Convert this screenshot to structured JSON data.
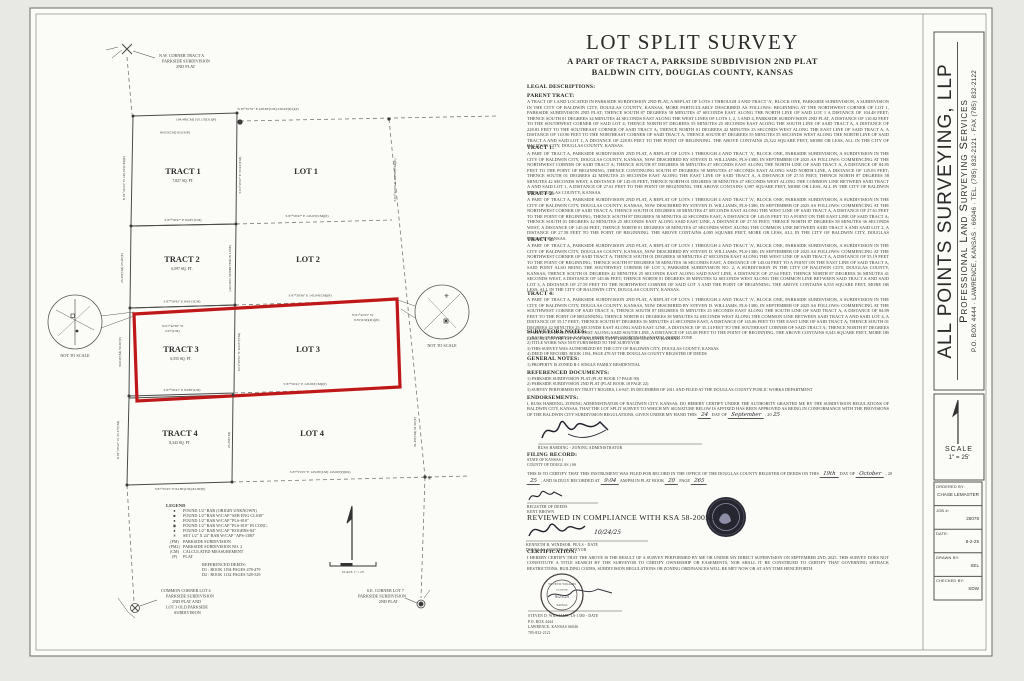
{
  "colors": {
    "paper": "#fbfbf7",
    "background": "#e8e8e4",
    "ink": "#3c3c3c",
    "line": "#4a4a4a",
    "highlight_red": "#c01818",
    "seal_dark": "#262630"
  },
  "header": {
    "title": "LOT SPLIT SURVEY",
    "subtitle1": "A PART OF TRACT A, PARKSIDE SUBDIVISION 2ND PLAT",
    "subtitle2": "BALDWIN CITY, DOUGLAS COUNTY, KANSAS"
  },
  "firm": {
    "name": "ALL POINTS SURVEYING, LLP",
    "tagline": "Professional Land Surveying Services",
    "address": "P.O. BOX 4444 · LAWRENCE, KANSAS · 66046 · TEL. (785) 832-2121 · FAX (785) 832-2122"
  },
  "titleblock": {
    "scale_label": "SCALE",
    "scale_value": "1\" = 25'",
    "fields": [
      {
        "label": "ORDERED BY:",
        "value": "CHASE LEMASTER"
      },
      {
        "label": "JOB #:",
        "value": "25078"
      },
      {
        "label": "DATE:",
        "value": "8-2-25"
      },
      {
        "label": "DRAWN BY:",
        "value": "SEL"
      },
      {
        "label": "CHECKED BY:",
        "value": "SDW"
      }
    ]
  },
  "legal": {
    "title": "LEGAL DESCRIPTIONS:",
    "sections": [
      {
        "heading": "PARENT TRACT:",
        "body": "A TRACT OF LAND LOCATED IN PARKSIDE SUBDIVISION 2ND PLAT, A REPLAT OF LOTS 1 THROUGH 4 AND TRACT 'A', BLOCK ONE, PARKSIDE SUBDIVISION, A SUBDIVISION IN THE CITY OF BALDWIN CITY, DOUGLAS COUNTY, KANSAS, MORE PARTICULARLY DESCRIBED AS FOLLOWS: BEGINNING AT THE NORTHWEST CORNER OF LOT 1, PARKSIDE SUBDIVISION 2ND PLAT; THENCE SOUTH 87 DEGREES 58 MINUTES 47 SECONDS EAST ALONG THE NORTH LINE OF SAID LOT 1 A DISTANCE OF 104.48 FEET; THENCE SOUTH 01 DEGREES 34 MINUTES 44 SECONDS EAST ALONG THE WEST LINES OF LOTS 1, 2, 3 AND 4, PARKSIDE SUBDIVISION 2ND PLAT, A DISTANCE OF 110.82 FEET TO THE SOUTHWEST CORNER OF SAID LOT 4; THENCE NORTH 87 DEGREES 55 MINUTES 25 SECONDS EAST ALONG THE SOUTH LINE OF SAID TRACT A, A DISTANCE OF 228.83 FEET TO THE SOUTHEAST CORNER OF SAID TRACT A; THENCE NORTH 01 DEGREES 42 MINUTES 25 SECONDS WEST ALONG THE EAST LINE OF SAID TRACT A, A DISTANCE OF 110.90 FEET TO THE NORTHEAST CORNER OF SAID TRACT A; THENCE SOUTH 87 DEGREES 55 MINUTES 55 SECONDS WEST ALONG THE NORTH LINE OF SAID TRACT A AND SAID LOT 1, A DISTANCE OF 228.83 FEET TO THE POINT OF BEGINNING. THE ABOVE CONTAINS 25,322 SQUARE FEET, MORE OR LESS, ALL IN THE CITY OF BALDWIN CITY, DOUGLAS COUNTY, KANSAS."
      },
      {
        "heading": "TRACT 1:",
        "body": "A PART OF TRACT A, PARKSIDE SUBDIVISION 2ND PLAT, A REPLAT OF LOTS 1 THROUGH 4 AND TRACT 'A', BLOCK ONE, PARKSIDE SUBDIVISION, A SUBDIVISION IN THE CITY OF BALDWIN CITY, DOUGLAS COUNTY, KANSAS, NOW DESCRIBED BY STEVEN D. WILLIAMS, PLS-1380, IN SEPTEMBER OF 2025 AS FOLLOWS: COMMENCING AT THE NORTHWEST CORNER OF SAID TRACT A; THENCE SOUTH 87 DEGREES 58 MINUTES 47 SECONDS EAST ALONG THE NORTH LINE OF SAID TRACT A, A DISTANCE OF 84.85 FEET TO THE POINT OF BEGINNING; THENCE CONTINUING SOUTH 87 DEGREES 58 MINUTES 47 SECONDS EAST ALONG SAID NORTH LINE, A DISTANCE OF 145.03 FEET; THENCE SOUTH 01 DEGREES 42 MINUTES 25 SECONDS EAST ALONG THE EAST LINE OF SAID TRACT A, A DISTANCE OF 27.55 FEET; THENCE NORTH 87 DEGREES 58 MINUTES 42 SECONDS WEST, A DISTANCE OF 145.05 FEET; THENCE NORTH 01 DEGREES 38 MINUTES 47 SECONDS WEST ALONG THE COMMON LINE BETWEEN SAID TRACT A AND SAID LOT 1, A DISTANCE OF 27.61 FEET TO THE POINT OF BEGINNING. THE ABOVE CONTAINS 3,997 SQUARE FEET, MORE OR LESS, ALL IN THE CITY OF BALDWIN CITY, DOUGLAS COUNTY, KANSAS."
      },
      {
        "heading": "TRACT 2:",
        "body": "A PART OF TRACT A, PARKSIDE SUBDIVISION 2ND PLAT, A REPLAT OF LOTS 1 THROUGH 4 AND TRACT 'A', BLOCK ONE, PARKSIDE SUBDIVISION, A SUBDIVISION IN THE CITY OF BALDWIN CITY, DOUGLAS COUNTY, KANSAS, NOW DESCRIBED BY STEVEN D. WILLIAMS, PLS-1380, IN SEPTEMBER OF 2025 AS FOLLOWS: COMMENCING AT THE NORTHWEST CORNER OF SAID TRACT A; THENCE SOUTH 01 DEGREES 38 MINUTES 47 SECONDS EAST ALONG THE WEST LINE OF SAID TRACT A, A DISTANCE OF 27.61 FEET TO THE POINT OF BEGINNING; THENCE SOUTH 87 DEGREES 58 MINUTES 42 SECONDS EAST, A DISTANCE OF 145.05 FEET TO A POINT ON THE EAST LINE OF SAID TRACT A; THENCE SOUTH 01 DEGREES 42 MINUTES 25 SECONDS EAST ALONG SAID EAST LINE, A DISTANCE OF 27.55 FEET; THENCE NORTH 87 DEGREES 58 MINUTES 36 SECONDS WEST, A DISTANCE OF 145.04 FEET; THENCE NORTH 01 DEGREES 38 MINUTES 47 SECONDS WEST ALONG THE COMMON LINE BETWEEN SAID TRACT A AND SAID LOT 2, A DISTANCE OF 27.58 FEET TO THE POINT OF BEGINNING. THE ABOVE CONTAINS 4,005 SQUARE FEET, MORE OR LESS, ALL IN THE CITY OF BALDWIN CITY, DOUGLAS COUNTY, KANSAS."
      },
      {
        "heading": "TRACT 3:",
        "body": "A PART OF TRACT A, PARKSIDE SUBDIVISION 2ND PLAT, A REPLAT OF LOTS 1 THROUGH 4 AND TRACT 'A', BLOCK ONE, PARKSIDE SUBDIVISION, A SUBDIVISION IN THE CITY OF BALDWIN CITY, DOUGLAS COUNTY, KANSAS, NOW DESCRIBED BY STEVEN D. WILLIAMS, PLS-1380, IN SEPTEMBER OF 2025 AS FOLLOWS: COMMENCING AT THE NORTHWEST CORNER OF SAID TRACT A; THENCE SOUTH 01 DEGREES 38 MINUTES 47 SECONDS EAST ALONG THE WEST LINE OF SAID TRACT A, A DISTANCE OF 55.19 FEET TO THE POINT OF BEGINNING; THENCE SOUTH 87 DEGREES 58 MINUTES 36 SECONDS EAST, A DISTANCE OF 145.04 FEET TO A POINT ON THE EAST LINE OF SAID TRACT A, SAID POINT ALSO BEING THE SOUTHWEST CORNER OF LOT 3, PARKSIDE SUBDIVISION NO. 2, A SUBDIVISION IN THE CITY OF BALDWIN CITY, DOUGLAS COUNTY, KANSAS; THENCE SOUTH 01 DEGREES 42 MINUTES 25 SECONDS EAST ALONG SAID EAST LINE, A DISTANCE OF 27.64 FEET; THENCE NORTH 87 DEGREES 56 MINUTES 41 SECONDS WEST, A DISTANCE OF 145.06 FEET; THENCE NORTH 01 DEGREES 38 MINUTES 52 SECONDS WEST ALONG THE COMMON LINE BETWEEN SAID TRACT A AND SAID LOT 3, A DISTANCE OF 27.59 FEET TO THE NORTHWEST CORNER OF SAID LOT 3 AND THE POINT OF BEGINNING. THE ABOVE CONTAINS 6,555 SQUARE FEET, MORE OR LESS, ALL IN THE CITY OF BALDWIN CITY, DOUGLAS COUNTY, KANSAS."
      },
      {
        "heading": "TRACT 4:",
        "body": "A PART OF TRACT A, PARKSIDE SUBDIVISION 2ND PLAT, A REPLAT OF LOTS 1 THROUGH 4 AND TRACT 'A', BLOCK ONE, PARKSIDE SUBDIVISION, A SUBDIVISION IN THE CITY OF BALDWIN CITY, DOUGLAS COUNTY, KANSAS, NOW DESCRIBED BY STEVEN D. WILLIAMS, PLS-1380, IN SEPTEMBER OF 2025 AS FOLLOWS: COMMENCING AT THE SOUTHWEST CORNER OF SAID TRACT A; THENCE SOUTH 87 DEGREES 55 MINUTES 25 SECONDS EAST ALONG THE SOUTH LINE OF SAID TRACT A, A DISTANCE OF 84.89 FEET TO THE POINT OF BEGINNING; THENCE NORTH 01 DEGREES 38 MINUTES 52 SECONDS WEST ALONG THE COMMON LINE BETWEEN SAID TRACT A AND SAID LOT 4, A DISTANCE OF 35.17 FEET; THENCE SOUTH 87 DEGREES 56 MINUTES 41 SECONDS EAST, A DISTANCE OF 145.06 FEET TO THE EAST LINE OF SAID TRACT A; THENCE SOUTH 01 DEGREES 42 MINUTES 25 SECONDS EAST ALONG SAID EAST LINE, A DISTANCE OF 35.14 FEET TO THE SOUTHEAST CORNER OF SAID TRACT A; THENCE NORTH 87 DEGREES 55 MINUTES 25 SECONDS WEST ALONG SAID SOUTH LINE, A DISTANCE OF 145.08 FEET TO THE POINT OF BEGINNING. THE ABOVE CONTAINS 8,343 SQUARE FEET, MORE OR LESS, ALL IN THE CITY OF BALDWIN CITY, DOUGLAS COUNTY, KANSAS."
      }
    ]
  },
  "notes": {
    "surveyors": {
      "heading": "SURVEYORS NOTES:",
      "lines": [
        "1) BASIS OF BEARINGS: KANSAS STATE PLANE COORDINATE SYSTEM, NORTH ZONE",
        "2) TITLE WORK WAS NOT FURNISHED TO THE SURVEYOR",
        "3) THIS SURVEY WAS AUTHORIZED BY THE CITY OF BALDWIN CITY, DOUGLAS COUNTY, KANSAS",
        "4) DEED OF RECORD: BOOK 1194, PAGE 478 AT THE DOUGLAS COUNTY REGISTER OF DEEDS"
      ]
    },
    "general": {
      "heading": "GENERAL NOTES:",
      "lines": [
        "1) PROPERTY IS ZONED R-1 SINGLE FAMILY RESIDENTIAL"
      ]
    },
    "refdocs": {
      "heading": "REFERENCED DOCUMENTS:",
      "lines": [
        "1) PARKSIDE SUBDIVISION PLAT (PLAT BOOK 17 PAGE 90)",
        "2) PARKSIDE SUBDIVISION 2ND PLAT (PLAT BOOK 18 PAGE 22)",
        "3) SURVEY PERFORMED BY TRUITT ROGERS, LS-847, IN DECEMBER OF 2011 AND FILED AT THE DOUGLAS COUNTY PUBLIC WORKS DEPARTMENT"
      ]
    }
  },
  "endorsements": {
    "heading": "ENDORSEMENTS:",
    "body": "I, RUSS HARDING, ZONING ADMINISTRATOR OF BALDWIN CITY, KANSAS, DO HEREBY CERTIFY UNDER THE AUTHORITY GRANTED ME BY THE SUBDIVISION REGULATIONS OF BALDWIN CITY, KANSAS, THAT THE LOT SPLIT SURVEY TO WHICH MY SIGNATURE BELOW IS AFFIXED HAS BEEN APPROVED AS BEING IN CONFORMANCE WITH THE PROVISIONS OF THE BALDWIN CITY SUBDIVISION REGULATIONS, GIVEN UNDER MY HAND THIS",
    "hand_day": "24",
    "mid1": "DAY OF",
    "hand_month": "September",
    "mid2": ", 20",
    "hand_year": "25",
    "tail": ".",
    "sig_caption": "RUSS HARDING  -  ZONING ADMINISTRATOR"
  },
  "filing": {
    "heading": "FILING RECORD:",
    "state": "STATE OF KANSAS )",
    "county": "COUNTY OF DOUGLAS ) SS",
    "l1": "THIS IS TO CERTIFY THAT THIS INSTRUMENT WAS FILED FOR RECORD IN THE OFFICE OF THE DOUGLAS COUNTY REGISTER OF DEEDS ON THIS",
    "h1": "19th",
    "l2": "DAY OF",
    "h2": "October",
    "l3": ", 20",
    "h3": "25",
    "l4": ", AND IS DULY RECORDED AT",
    "h4": "9:04",
    "l5": "AM/PM IN",
    "l6": "PLAT BOOK",
    "h5": "20",
    "l7": "PAGE",
    "h6": "265",
    "l8": ".",
    "cap1": "REGISTER OF DEEDS",
    "cap2": "KENT BROWN"
  },
  "reviewed": {
    "heading": "REVIEWED IN COMPLIANCE WITH KSA 58-2005 :",
    "hand_date": "10/24/25",
    "cap1": "KENNETH B. WINDSOR, PE/LS  -  DATE",
    "cap2": "DOUGLAS COUNTY SURVEYOR"
  },
  "certification": {
    "heading": "CERTIFICATION:",
    "body": "I HEREBY CERTIFY THAT THE ABOVE IS THE RESULT OF A SURVEY PERFORMED BY ME OR UNDER MY DIRECT SUPERVISION ON SEPTEMBER 2ND, 2025. THIS SURVEY DOES NOT CONSTITUTE A TITLE SEARCH BY THE SURVEYOR TO CERTIFY OWNERSHIP OR EASEMENTS, NOR SHALL IT BE CONSTRUED TO CERTIFY THAT GOVERNING SETBACK RESTRICTIONS, BUILDING CODES, SUBDIVISION REGULATIONS OR ZONING ORDINANCES WILL BE MET NOW OR AT ANY TIME HENCEFORTH."
  },
  "stamp": {
    "arc_top": "STEVEN D. WILLIAMS",
    "mid": "LICENSED",
    "hand_date": "9/23/25",
    "arc_bottom": "KANSAS",
    "cap1": "STEVEN D. WILLIAMS, LS-1380  -  DATE",
    "cap2": "P.O. BOX 4444",
    "cap3": "LAWRENCE, KANSAS 66046",
    "cap4": "785-832-2121"
  },
  "drawing": {
    "corner_nw": [
      "N.W. CORNER TRACT A",
      "PARKSIDE SUBDIVISION",
      "2ND PLAT"
    ],
    "corner_sw": [
      "COMMON CORNER LOT 4",
      "PARKSIDE SUBDIVISION",
      "2ND PLAT AND",
      "LOT 3 OLD PARKSIDE",
      "SUBDIVISION"
    ],
    "corner_se": [
      "S.E. CORNER LOT 7",
      "PARKSIDE SUBDIVISION",
      "2ND PLAT"
    ],
    "tracts": [
      {
        "name": "TRACT 1",
        "area": "7,827 SQ. FT."
      },
      {
        "name": "TRACT 2",
        "area": "6,597 SQ. FT."
      },
      {
        "name": "TRACT 3",
        "area": "6,555 SQ. FT."
      },
      {
        "name": "TRACT 4",
        "area": "8,343 SQ. FT."
      }
    ],
    "lots": [
      "LOT 1",
      "LOT 2",
      "LOT 3",
      "LOT 4"
    ],
    "not_to_scale": "NOT TO SCALE",
    "north_caption": "SCALE 1\" = 25'",
    "bearings": {
      "top_left": "104.48'(CM) 105.13'(D1)(P)",
      "top_inner": "84.05'(CM) 85.03'(P)",
      "top": "N 87°55'55\" E  228.83'(CM) 230.03'(D1)(P)",
      "t12_left": "S 87°58'47\" E  84.85'(CM)",
      "t12_right": "S 87°58'47\" E  145.03'(CM)(P)",
      "t23_left": "S 87°58'42\" E  84.91'(CM)",
      "t23_right": "S 87°58'36\" E  145.04'(CM)(P)",
      "detail_left_1": "N 01°42'38\" W",
      "detail_left_2": "2.97'(CM)",
      "detail_right_1": "N 01°42'25\" W",
      "detail_right_2": "8.35'(CM)(D1)(P)",
      "t34_left": "S 87°56'41\" E  84.88'(CM)",
      "t34_right": "S 87°56'41\" E  145.06'(CM)(P)",
      "bottom_left": "S 87°55'25\" E  84.89'(CM) 84.99'(P)",
      "bottom_right": "S 87°55'25\" E  145.08'(CM) 145.00'(P)(D2)",
      "w1": "N 01°34'44\" W  110.82'(CM)(P)",
      "w2": "25.38'(CM) 25.40'(P)",
      "w3": "50.03'(CM) 50.30'(P)",
      "w4": "N 01°35'12\" W  35.17'(CM)",
      "m1": "S 01°38'47\" E  55.94'(CM)",
      "m2": "(ALONG SUBDIVISION LINE)",
      "m3": "S 01°38'52\" E  110.87'(CM)",
      "m4": "25.38'(CM)",
      "e1": "S 01°42'25\" E  110.90'(CM)(P)",
      "e2": "81.48'(CM) 81.50'(P)"
    }
  },
  "legend": {
    "title": "LEGEND",
    "items": [
      {
        "sym": "●",
        "text": "FOUND 1/2\" BAR (ORIGIN UNKNOWN)"
      },
      {
        "sym": "■",
        "text": "FOUND 1/2\" BAR W/CAP \"SEB ENG CLS30\""
      },
      {
        "sym": "●",
        "text": "FOUND 1/2\" BAR W/CAP \"PLS-810\""
      },
      {
        "sym": "◉",
        "text": "FOUND 1/2\" BAR W/CAP \"PLS-810\" IN CONC."
      },
      {
        "sym": "●",
        "text": "FOUND 1/2\" BAR W/CAP \"ROGERS-84\""
      },
      {
        "sym": "✳",
        "text": "SET 1/2\" X 24\" BAR W/CAP \"APS-1380\""
      },
      {
        "sym": "(PM)",
        "text": "PARKSIDE SUBDIVISION"
      },
      {
        "sym": "(PM2)",
        "text": "PARKSIDE SUBDIVISION NO. 2"
      },
      {
        "sym": "(CM)",
        "text": "CALCULATED MEASUREMENT"
      },
      {
        "sym": "(P)",
        "text": "PLAT"
      }
    ],
    "deeds_title": "REFERENCED DEEDS:",
    "deeds": [
      "D1 :  BOOK 1194 PAGES 478-479",
      "D2 :  BOOK 1132 PAGES 528-529"
    ]
  }
}
